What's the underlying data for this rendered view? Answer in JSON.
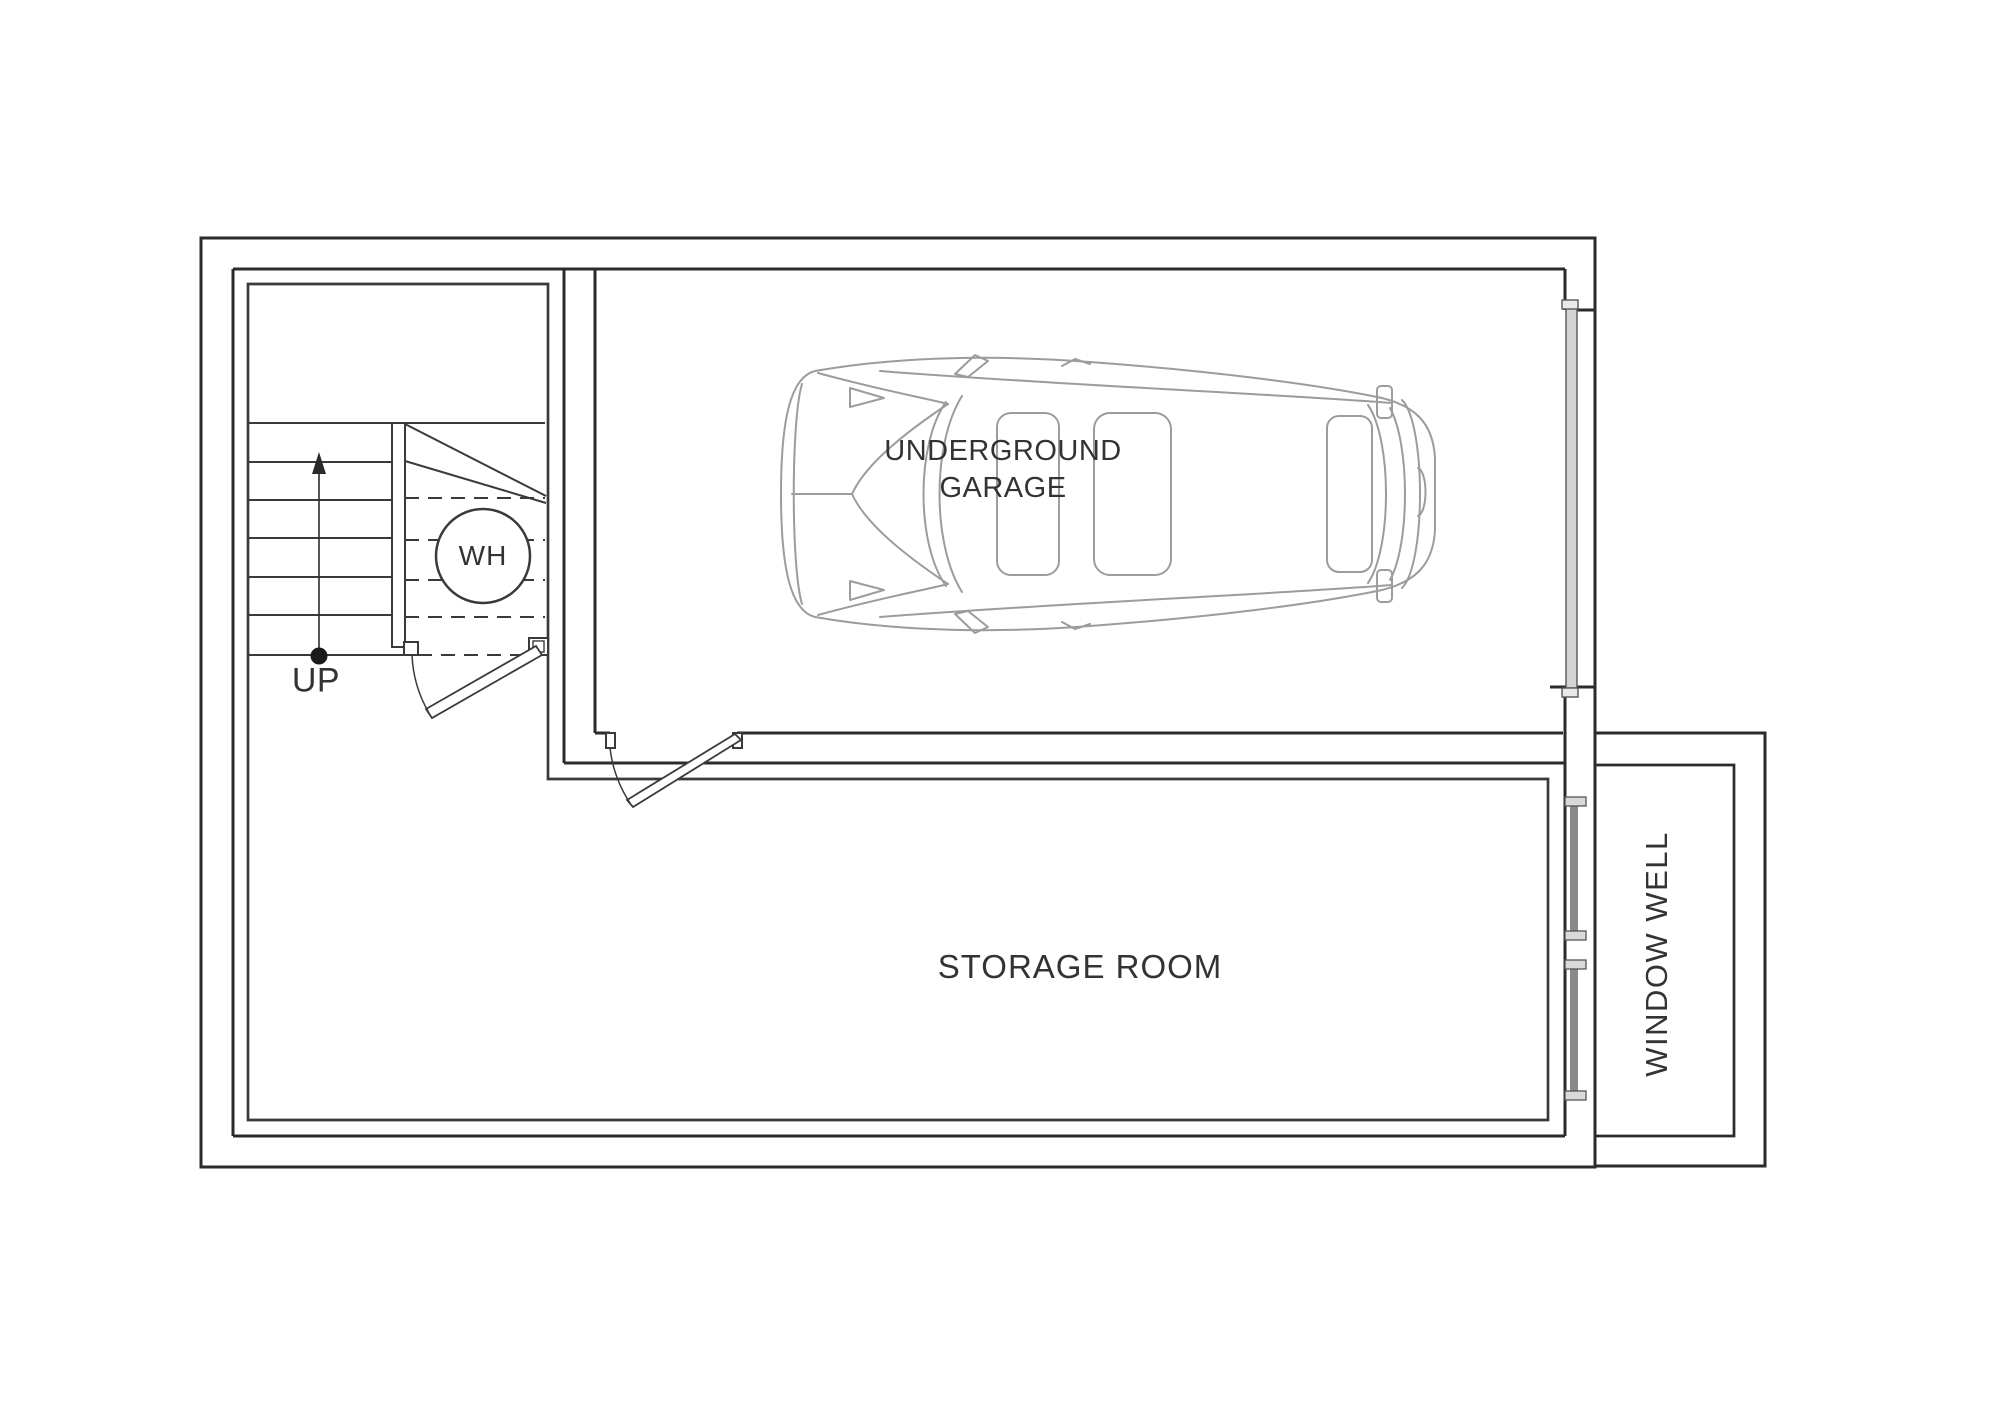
{
  "labels": {
    "garage_line1": "UNDERGROUND",
    "garage_line2": "GARAGE",
    "storage_room": "STORAGE ROOM",
    "window_well": "WINDOW WELL",
    "water_heater": "WH",
    "stairs_direction": "UP"
  },
  "colors": {
    "background": "#ffffff",
    "wall_line": "#2b2b2b",
    "thin_line": "#3a3a3a",
    "car_line": "#9c9c9c",
    "door_panel_fill": "#d4d4d4",
    "window_glass_fill": "#8a8a8a",
    "text": "#333333"
  }
}
